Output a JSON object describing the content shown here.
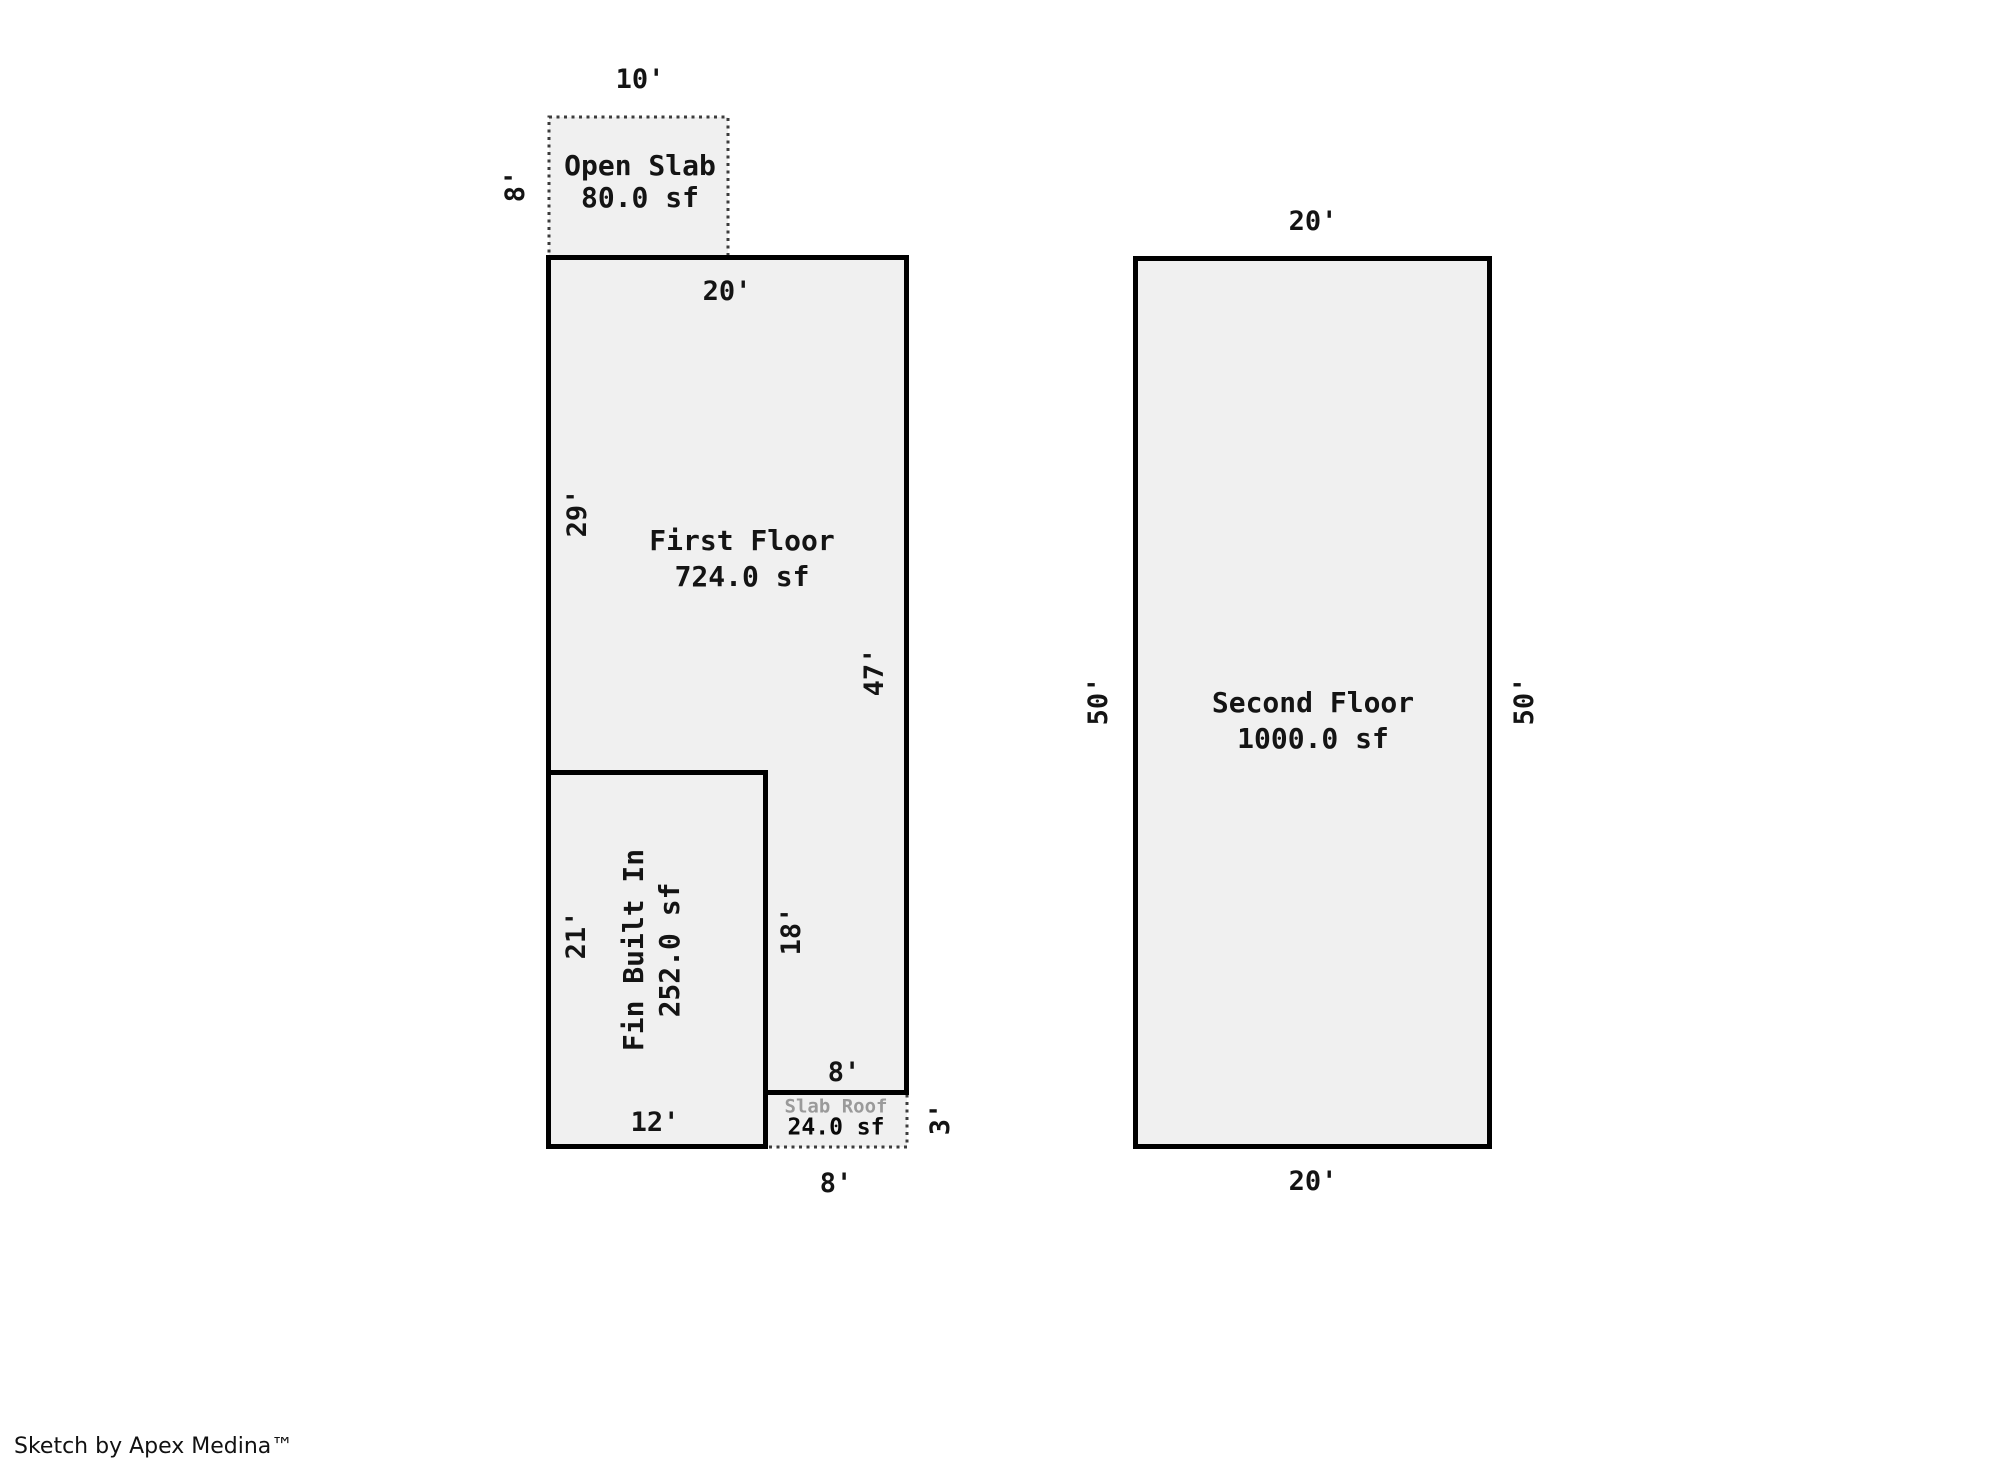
{
  "page": {
    "kind": "floor-plan-sketch",
    "footer": "Sketch by Apex Medina™"
  },
  "colors": {
    "background": "#ffffff",
    "area_fill": "#f0f0f0",
    "outline": "#000000",
    "dotted_outline": "#3c3c3c",
    "muted_label": "#9a9a9a"
  },
  "areas": {
    "first_floor": {
      "name": "First Floor",
      "area": "724.0 sf",
      "dims": {
        "top": "20'",
        "left": "29'",
        "right": "47'",
        "notch_height": "18'",
        "notch_width": "8'"
      }
    },
    "fin_built_in": {
      "name": "Fin Built In",
      "area": "252.0 sf",
      "dims": {
        "left": "21'",
        "bottom": "12'"
      }
    },
    "open_slab": {
      "name": "Open Slab",
      "area": "80.0 sf",
      "dims": {
        "top": "10'",
        "left": "8'"
      }
    },
    "slab_roof": {
      "name": "Slab Roof",
      "area": "24.0 sf",
      "dims": {
        "right": "3'",
        "bottom": "8'"
      }
    },
    "second_floor": {
      "name": "Second Floor",
      "area": "1000.0 sf",
      "dims": {
        "top": "20'",
        "left": "50'",
        "right": "50'",
        "bottom": "20'"
      }
    }
  }
}
